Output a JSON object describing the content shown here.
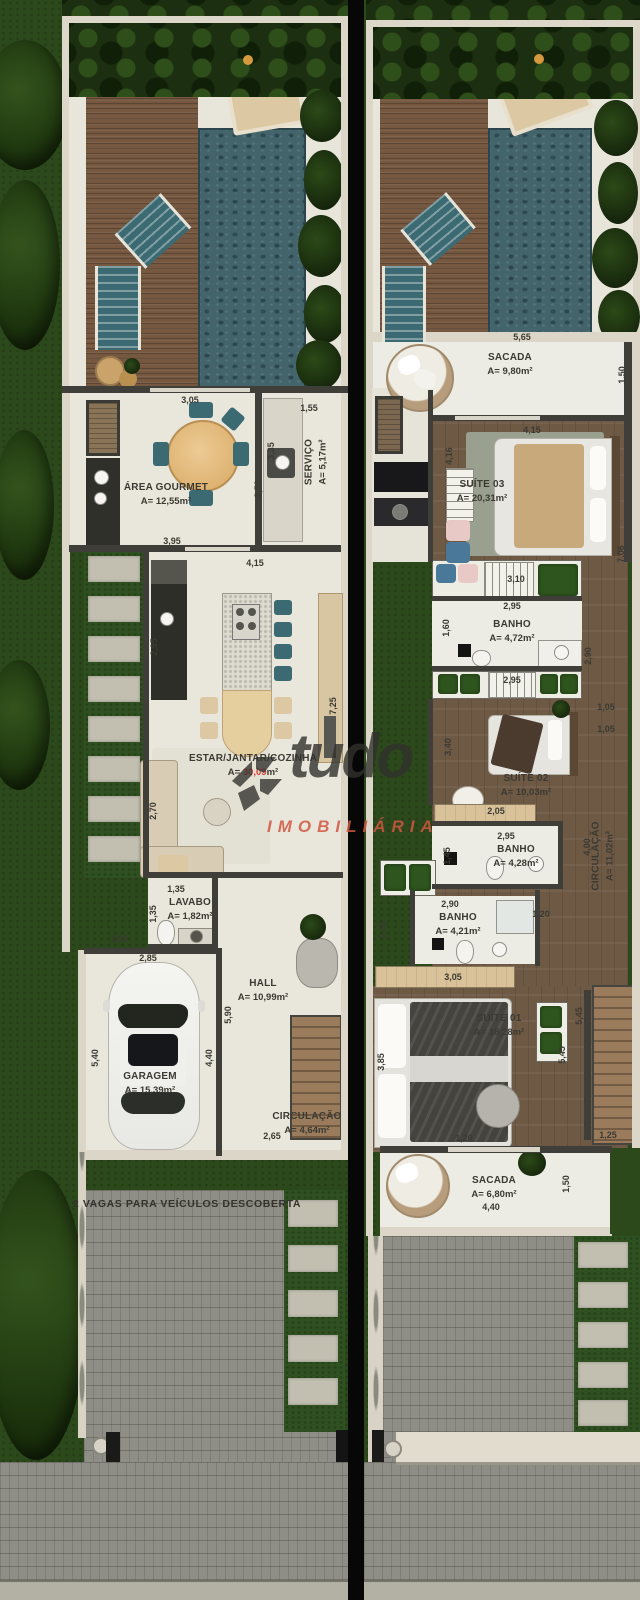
{
  "watermark": {
    "brand": "tudo",
    "subtitle": "IMOBILIÁRIA"
  },
  "ground": {
    "rooms": {
      "gourmet": {
        "name": "ÁREA GOURMET",
        "area": "A= 12,55m²"
      },
      "servico": {
        "name": "SERVIÇO",
        "area": "A= 5,17m²"
      },
      "estar": {
        "name": "ESTAR/JANTAR/COZINHA",
        "area_prefix": "A= ",
        "area_value": "30,09",
        "area_unit": "m²"
      },
      "lavabo": {
        "name": "LAVABO",
        "area": "A= 1,82m²"
      },
      "hall": {
        "name": "HALL",
        "area": "A= 10,99m²"
      },
      "garagem": {
        "name": "GARAGEM",
        "area": "A= 15,39m²"
      },
      "circulacao": {
        "name": "CIRCULAÇÃO",
        "area": "A= 4,64m²"
      }
    },
    "note": "2 VAGAS PARA VEÍCULOS DESCOBERTA",
    "dims": {
      "a": "3,05",
      "b": "1,55",
      "c": "3,35",
      "d": "3,50",
      "e": "3,95",
      "f": "4,15",
      "g": "2,95",
      "h": "7,25",
      "i": "2,70",
      "j": "1,35",
      "k": "1,35",
      "l": "1,55",
      "m": "2,85",
      "n": "5,90",
      "o": "5,40",
      "p": "4,40",
      "q": "2,65"
    }
  },
  "upper": {
    "rooms": {
      "sacada1": {
        "name": "SACADA",
        "area": "A= 9,80m²"
      },
      "suite3": {
        "name": "SUÍTE 03",
        "area": "A= 20,31m²"
      },
      "banho3": {
        "name": "BANHO",
        "area": "A= 4,72m²"
      },
      "suite2": {
        "name": "SUÍTE 02",
        "area": "A= 10,03m²"
      },
      "banho2": {
        "name": "BANHO",
        "area": "A= 4,28m²"
      },
      "circ": {
        "name": "CIRCULAÇÃO",
        "area": "A= 11,02m²"
      },
      "banho1": {
        "name": "BANHO",
        "area": "A= 4,21m²"
      },
      "suite1": {
        "name": "SUÍTE 01",
        "area": "A= 18,28m²"
      },
      "sacada2": {
        "name": "SACADA",
        "area": "A= 6,80m²"
      }
    },
    "dims": {
      "a": "5,65",
      "b": "1,50",
      "c": "4,15",
      "d": "4,16",
      "e": "3,10",
      "f": "2,95",
      "g": "1,60",
      "h": "7,06",
      "i": "2,90",
      "j": "1,05",
      "k": "1,05",
      "l": "3,40",
      "m": "2,05",
      "n": "2,95",
      "n2": "2,95",
      "o": "1,45",
      "p": "4,00",
      "q": "2,90",
      "r": "1,45",
      "s": "1,20",
      "t": "3,05",
      "u": "3,85",
      "v": "5,45",
      "w": "5,45",
      "x": "1,25",
      "y": "1,20",
      "z": "4,40",
      "z2": "1,50"
    }
  }
}
